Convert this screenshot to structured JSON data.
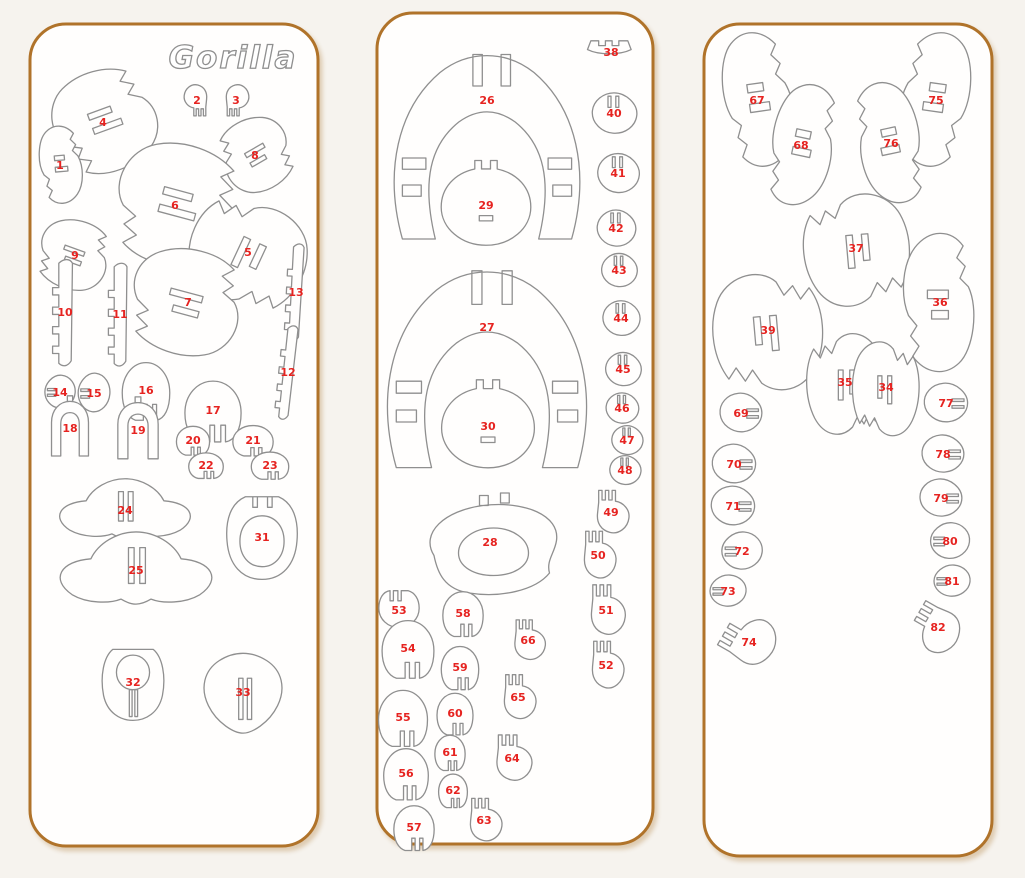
{
  "title": {
    "text": "Gorilla"
  },
  "colors": {
    "page_bg": "#f6f3ee",
    "panel_fill": "#fffefd",
    "panel_border": "#b0732a",
    "piece_outline": "#8f8f8f",
    "number_red": "#e62320"
  },
  "panels": [
    {
      "name": "sheet-1",
      "x": 30,
      "y": 24,
      "w": 288,
      "h": 822,
      "pieces": [
        {
          "n": "4",
          "s": "blobComb",
          "x": 103,
          "y": 122,
          "w": 150,
          "h": 125,
          "r": -20
        },
        {
          "n": "2",
          "s": "handShape",
          "x": 197,
          "y": 100,
          "w": 40,
          "h": 44,
          "r": 180
        },
        {
          "n": "3",
          "s": "handShape",
          "x": 236,
          "y": 100,
          "w": 40,
          "h": 44,
          "r": 180,
          "f": 1
        },
        {
          "n": "1",
          "s": "blobComb",
          "x": 60,
          "y": 165,
          "w": 62,
          "h": 95,
          "r": -5
        },
        {
          "n": "8",
          "s": "blobComb",
          "x": 255,
          "y": 155,
          "w": 105,
          "h": 90,
          "r": 150,
          "f": 1
        },
        {
          "n": "6",
          "s": "blobComb",
          "x": 175,
          "y": 205,
          "w": 185,
          "h": 150,
          "r": 15
        },
        {
          "n": "9",
          "s": "blobComb",
          "x": 75,
          "y": 255,
          "w": 105,
          "h": 85,
          "r": 200
        },
        {
          "n": "5",
          "s": "blobComb",
          "x": 248,
          "y": 252,
          "w": 155,
          "h": 145,
          "r": 115
        },
        {
          "n": "13",
          "s": "combStrip",
          "x": 296,
          "y": 292,
          "w": 48,
          "h": 112,
          "r": 3
        },
        {
          "n": "10",
          "s": "combStrip",
          "x": 65,
          "y": 312,
          "w": 62,
          "h": 122
        },
        {
          "n": "11",
          "s": "combStrip",
          "x": 120,
          "y": 314,
          "w": 58,
          "h": 118
        },
        {
          "n": "7",
          "s": "blobComb",
          "x": 188,
          "y": 302,
          "w": 165,
          "h": 130,
          "r": 195
        },
        {
          "n": "12",
          "s": "combStrip",
          "x": 288,
          "y": 372,
          "w": 46,
          "h": 108,
          "r": 6
        },
        {
          "n": "14",
          "s": "roundlet",
          "x": 60,
          "y": 392,
          "w": 42,
          "h": 44
        },
        {
          "n": "15",
          "s": "roundlet",
          "x": 94,
          "y": 393,
          "w": 44,
          "h": 52
        },
        {
          "n": "16",
          "s": "dome",
          "x": 146,
          "y": 390,
          "w": 66,
          "h": 72
        },
        {
          "n": "17",
          "s": "dome",
          "x": 213,
          "y": 410,
          "w": 78,
          "h": 76
        },
        {
          "n": "18",
          "s": "archPiece",
          "x": 70,
          "y": 428,
          "w": 66,
          "h": 70
        },
        {
          "n": "19",
          "s": "archPiece",
          "x": 138,
          "y": 430,
          "w": 72,
          "h": 72
        },
        {
          "n": "20",
          "s": "dome",
          "x": 193,
          "y": 440,
          "w": 46,
          "h": 36
        },
        {
          "n": "21",
          "s": "dome",
          "x": 253,
          "y": 440,
          "w": 56,
          "h": 38
        },
        {
          "n": "22",
          "s": "dome",
          "x": 206,
          "y": 465,
          "w": 48,
          "h": 32
        },
        {
          "n": "23",
          "s": "dome",
          "x": 270,
          "y": 465,
          "w": 52,
          "h": 34
        },
        {
          "n": "24",
          "s": "plate24",
          "x": 125,
          "y": 510,
          "w": 162,
          "h": 92
        },
        {
          "n": "31",
          "s": "plate31",
          "x": 262,
          "y": 537,
          "w": 92,
          "h": 106
        },
        {
          "n": "25",
          "s": "plate24",
          "x": 136,
          "y": 570,
          "w": 188,
          "h": 112
        },
        {
          "n": "32",
          "s": "plate32",
          "x": 133,
          "y": 682,
          "w": 92,
          "h": 96
        },
        {
          "n": "33",
          "s": "plate33",
          "x": 243,
          "y": 692,
          "w": 108,
          "h": 98
        }
      ]
    },
    {
      "name": "sheet-2",
      "x": 377,
      "y": 13,
      "w": 276,
      "h": 831,
      "pieces": [
        {
          "n": "26",
          "s": "fanRing",
          "x": 487,
          "y": 140,
          "w": 235,
          "h": 225,
          "ny": 100
        },
        {
          "n": "38",
          "s": "crownPiece",
          "x": 611,
          "y": 52,
          "w": 56,
          "h": 40
        },
        {
          "n": "40",
          "s": "roundlet",
          "x": 614,
          "y": 113,
          "w": 56,
          "h": 60,
          "r": 90
        },
        {
          "n": "29",
          "s": "hubCircle",
          "x": 486,
          "y": 205,
          "w": 112,
          "h": 106
        },
        {
          "n": "41",
          "s": "roundlet",
          "x": 618,
          "y": 173,
          "w": 54,
          "h": 56,
          "r": 90
        },
        {
          "n": "42",
          "s": "roundlet",
          "x": 616,
          "y": 228,
          "w": 50,
          "h": 52,
          "r": 90
        },
        {
          "n": "43",
          "s": "roundlet",
          "x": 619,
          "y": 270,
          "w": 46,
          "h": 48,
          "r": 90
        },
        {
          "n": "27",
          "s": "fanRing",
          "x": 487,
          "y": 362,
          "w": 252,
          "h": 240,
          "ny": 327
        },
        {
          "n": "44",
          "s": "roundlet",
          "x": 621,
          "y": 318,
          "w": 48,
          "h": 50,
          "r": 90
        },
        {
          "n": "45",
          "s": "roundlet",
          "x": 623,
          "y": 369,
          "w": 46,
          "h": 48,
          "r": 90
        },
        {
          "n": "30",
          "s": "hubCircle",
          "x": 488,
          "y": 426,
          "w": 116,
          "h": 110
        },
        {
          "n": "46",
          "s": "roundlet",
          "x": 622,
          "y": 408,
          "w": 42,
          "h": 44,
          "r": 90
        },
        {
          "n": "47",
          "s": "roundlet",
          "x": 627,
          "y": 440,
          "w": 40,
          "h": 42,
          "r": 90
        },
        {
          "n": "48",
          "s": "roundlet",
          "x": 625,
          "y": 470,
          "w": 40,
          "h": 42,
          "r": 90
        },
        {
          "n": "49",
          "s": "handShape",
          "x": 611,
          "y": 512,
          "w": 56,
          "h": 60
        },
        {
          "n": "28",
          "s": "bigBlob",
          "x": 490,
          "y": 548,
          "w": 175,
          "h": 125,
          "ny": 542
        },
        {
          "n": "50",
          "s": "handShape",
          "x": 598,
          "y": 555,
          "w": 56,
          "h": 66
        },
        {
          "n": "51",
          "s": "handShape",
          "x": 606,
          "y": 610,
          "w": 60,
          "h": 70
        },
        {
          "n": "53",
          "s": "dome",
          "x": 399,
          "y": 610,
          "w": 56,
          "h": 46,
          "r": 180
        },
        {
          "n": "58",
          "s": "dome",
          "x": 463,
          "y": 613,
          "w": 56,
          "h": 56
        },
        {
          "n": "66",
          "s": "handShape",
          "x": 528,
          "y": 640,
          "w": 54,
          "h": 56
        },
        {
          "n": "54",
          "s": "dome",
          "x": 408,
          "y": 648,
          "w": 72,
          "h": 72
        },
        {
          "n": "59",
          "s": "dome",
          "x": 460,
          "y": 667,
          "w": 52,
          "h": 54
        },
        {
          "n": "52",
          "s": "handShape",
          "x": 606,
          "y": 665,
          "w": 56,
          "h": 66
        },
        {
          "n": "65",
          "s": "handShape",
          "x": 518,
          "y": 697,
          "w": 56,
          "h": 62
        },
        {
          "n": "55",
          "s": "dome",
          "x": 403,
          "y": 717,
          "w": 68,
          "h": 70
        },
        {
          "n": "60",
          "s": "dome",
          "x": 455,
          "y": 713,
          "w": 50,
          "h": 52
        },
        {
          "n": "61",
          "s": "dome",
          "x": 450,
          "y": 752,
          "w": 42,
          "h": 44
        },
        {
          "n": "64",
          "s": "handShape",
          "x": 512,
          "y": 758,
          "w": 62,
          "h": 64
        },
        {
          "n": "56",
          "s": "dome",
          "x": 406,
          "y": 773,
          "w": 62,
          "h": 64
        },
        {
          "n": "62",
          "s": "dome",
          "x": 453,
          "y": 790,
          "w": 40,
          "h": 42
        },
        {
          "n": "57",
          "s": "dome",
          "x": 414,
          "y": 827,
          "w": 56,
          "h": 56
        },
        {
          "n": "63",
          "s": "handShape",
          "x": 484,
          "y": 820,
          "w": 56,
          "h": 60
        }
      ]
    },
    {
      "name": "sheet-3",
      "x": 704,
      "y": 24,
      "w": 288,
      "h": 832,
      "pieces": [
        {
          "n": "67",
          "s": "blobComb",
          "x": 757,
          "y": 100,
          "w": 100,
          "h": 165,
          "r": -8
        },
        {
          "n": "75",
          "s": "blobComb",
          "x": 936,
          "y": 100,
          "w": 100,
          "h": 165,
          "r": 8,
          "f": 1
        },
        {
          "n": "68",
          "s": "blobComb",
          "x": 801,
          "y": 145,
          "w": 92,
          "h": 150,
          "r": 12
        },
        {
          "n": "76",
          "s": "blobComb",
          "x": 891,
          "y": 143,
          "w": 92,
          "h": 150,
          "r": -12,
          "f": 1
        },
        {
          "n": "37",
          "s": "blobComb",
          "x": 856,
          "y": 248,
          "w": 165,
          "h": 130,
          "r": 85
        },
        {
          "n": "39",
          "s": "blobComb",
          "x": 768,
          "y": 330,
          "w": 175,
          "h": 135,
          "r": 265,
          "f": 1
        },
        {
          "n": "36",
          "s": "blobComb",
          "x": 940,
          "y": 302,
          "w": 105,
          "h": 170,
          "r": 180
        },
        {
          "n": "35",
          "s": "blobComb",
          "x": 845,
          "y": 382,
          "w": 150,
          "h": 95,
          "r": 90
        },
        {
          "n": "34",
          "s": "blobComb",
          "x": 886,
          "y": 387,
          "w": 140,
          "h": 82,
          "r": 270,
          "f": 1
        },
        {
          "n": "69",
          "s": "roundlet",
          "x": 741,
          "y": 413,
          "w": 58,
          "h": 52,
          "f": 1
        },
        {
          "n": "77",
          "s": "roundlet",
          "x": 946,
          "y": 403,
          "w": 60,
          "h": 52,
          "f": 1
        },
        {
          "n": "70",
          "s": "roundlet",
          "x": 734,
          "y": 464,
          "w": 60,
          "h": 52,
          "f": 1
        },
        {
          "n": "78",
          "s": "roundlet",
          "x": 943,
          "y": 454,
          "w": 58,
          "h": 50,
          "f": 1
        },
        {
          "n": "71",
          "s": "roundlet",
          "x": 733,
          "y": 506,
          "w": 60,
          "h": 52,
          "f": 1
        },
        {
          "n": "79",
          "s": "roundlet",
          "x": 941,
          "y": 498,
          "w": 58,
          "h": 50,
          "f": 1
        },
        {
          "n": "72",
          "s": "roundlet",
          "x": 742,
          "y": 551,
          "w": 56,
          "h": 50
        },
        {
          "n": "80",
          "s": "roundlet",
          "x": 950,
          "y": 541,
          "w": 54,
          "h": 48
        },
        {
          "n": "73",
          "s": "roundlet",
          "x": 728,
          "y": 591,
          "w": 50,
          "h": 42
        },
        {
          "n": "81",
          "s": "roundlet",
          "x": 952,
          "y": 581,
          "w": 50,
          "h": 42
        },
        {
          "n": "74",
          "s": "handShape",
          "x": 749,
          "y": 642,
          "w": 82,
          "h": 72,
          "r": -60
        },
        {
          "n": "82",
          "s": "handShape",
          "x": 938,
          "y": 627,
          "w": 76,
          "h": 66,
          "r": -60,
          "f": 1
        }
      ]
    }
  ]
}
